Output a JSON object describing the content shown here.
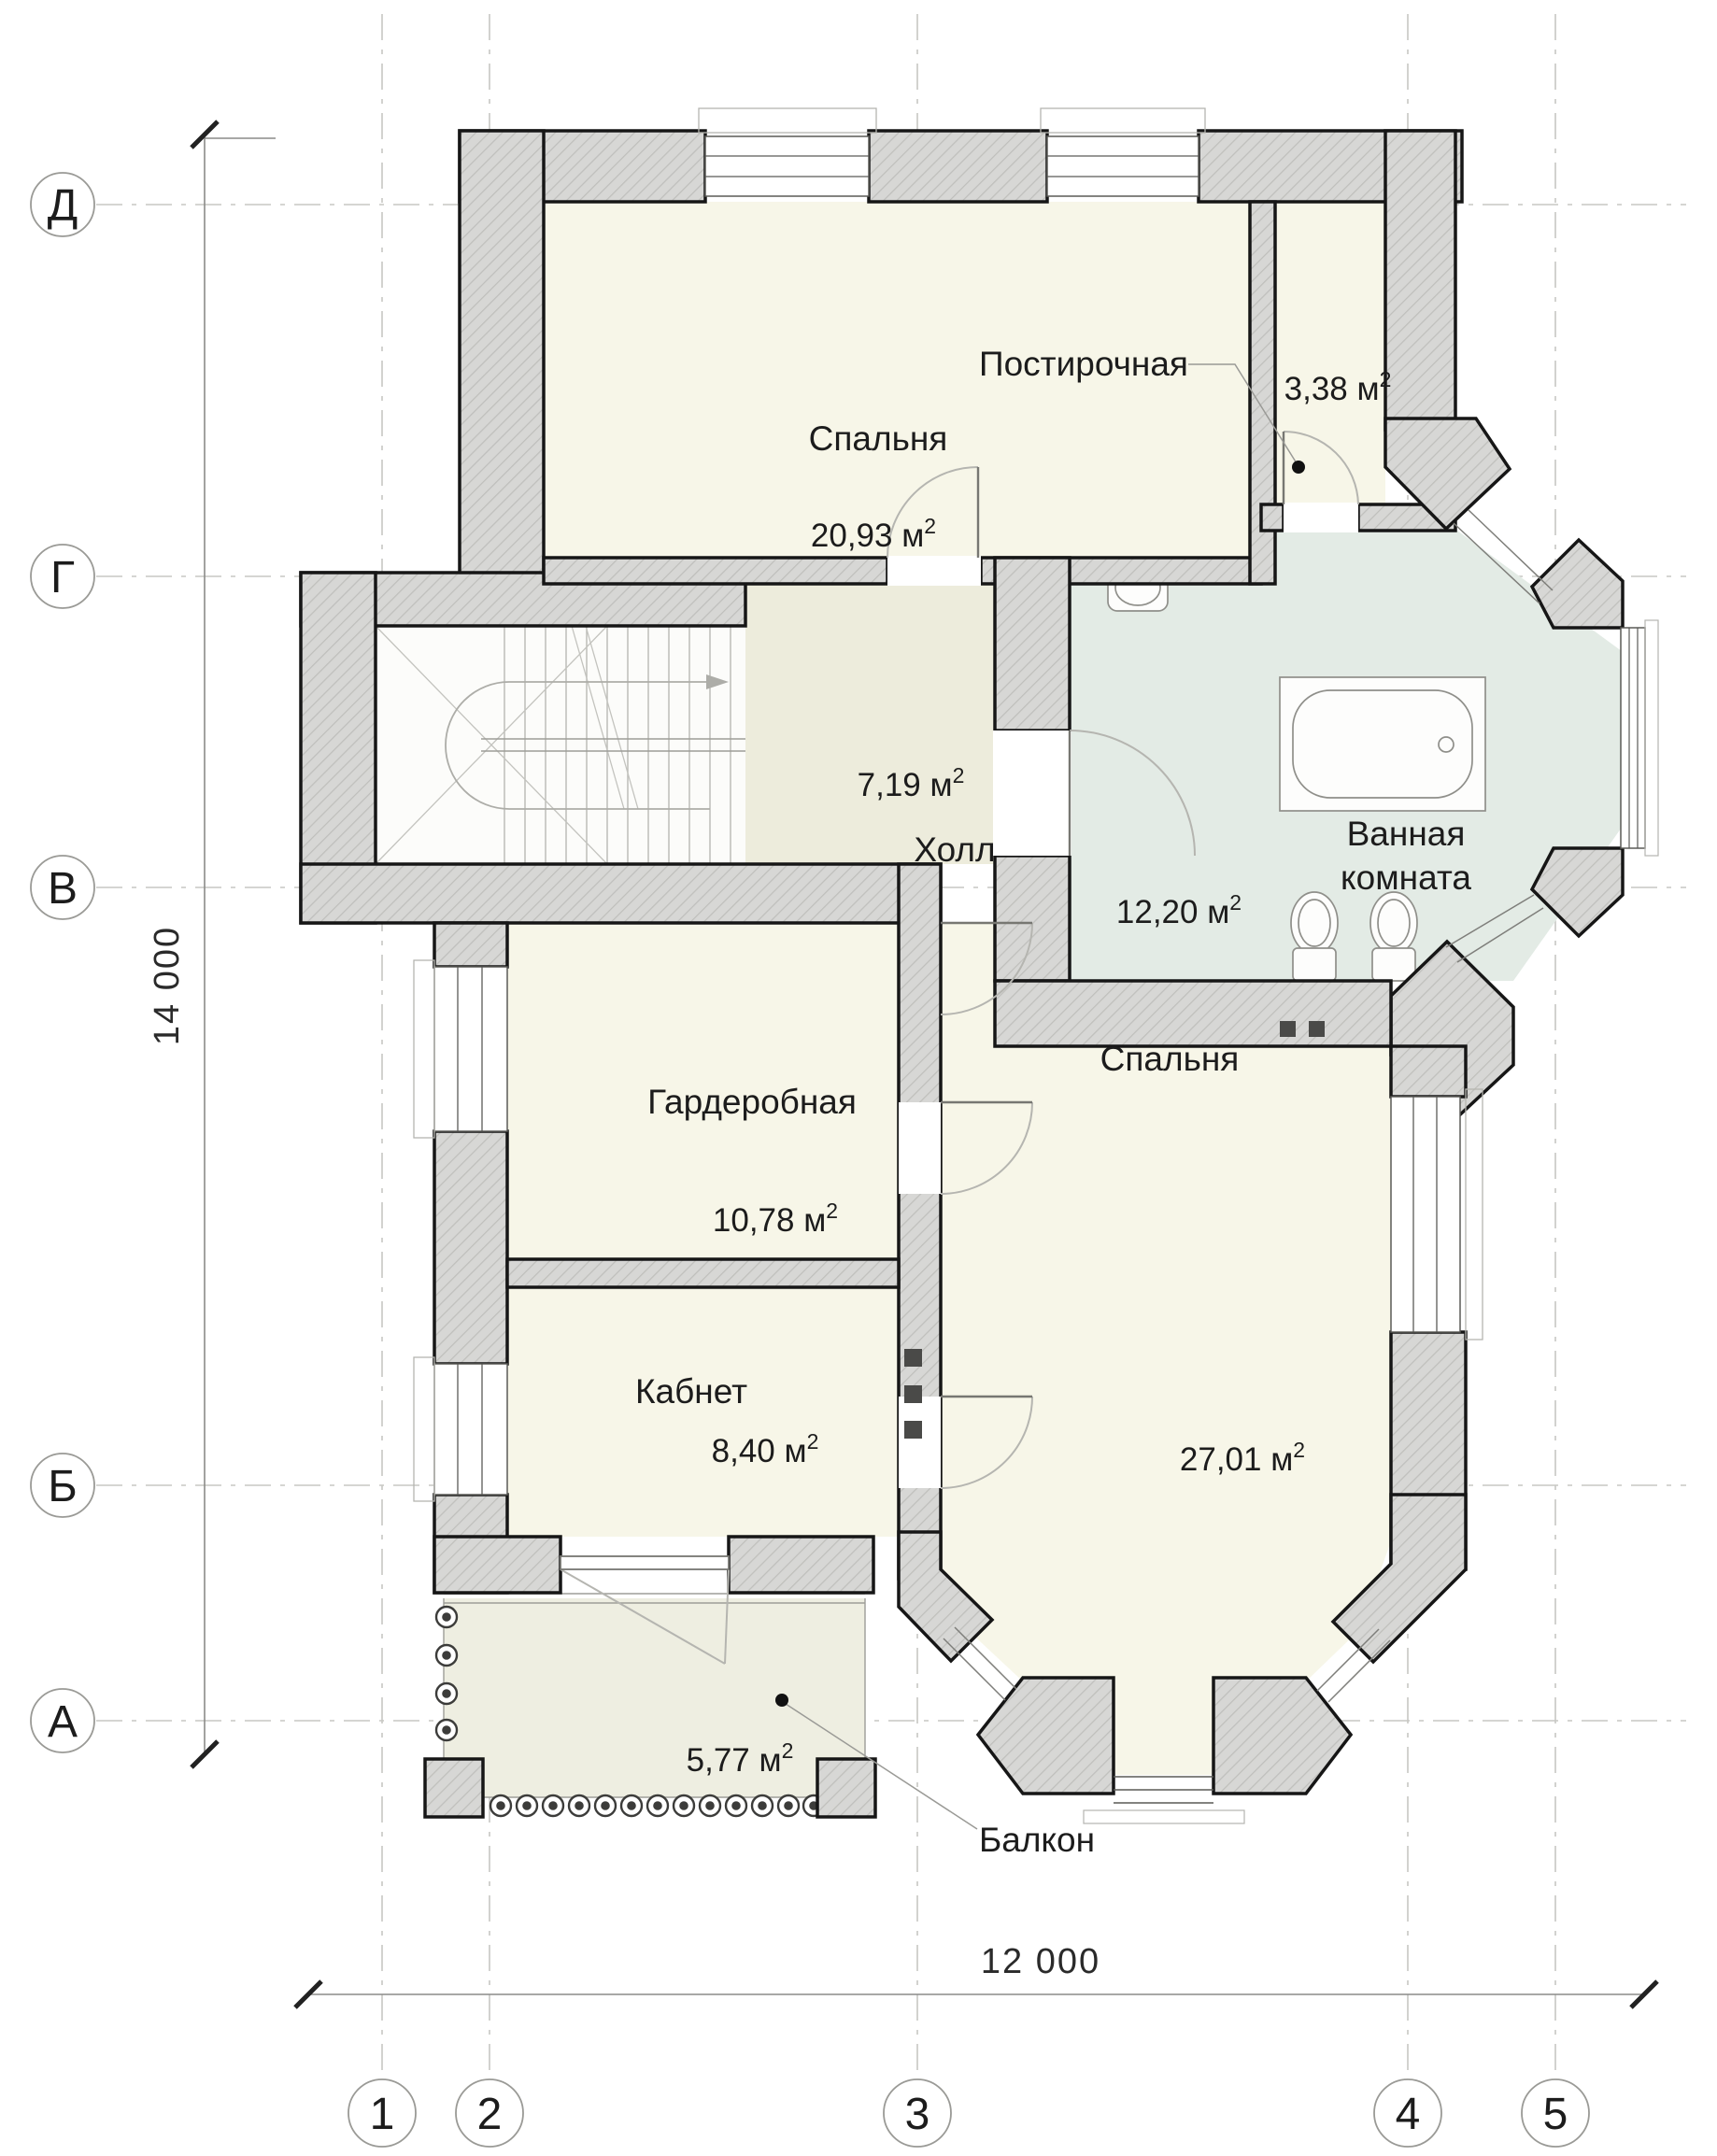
{
  "plan": {
    "type": "floor-plan",
    "rooms": [
      {
        "id": "bedroom-1",
        "name": "Спальня",
        "area": "20,93 м",
        "area_sup": "2"
      },
      {
        "id": "laundry",
        "name": "Постирочная",
        "area": "3,38 м",
        "area_sup": "2"
      },
      {
        "id": "hall",
        "name": "Холл",
        "area": "7,19 м",
        "area_sup": "2"
      },
      {
        "id": "bathroom",
        "name": "Ванная комната",
        "name_line1": "Ванная",
        "name_line2": "комната",
        "area": "12,20 м",
        "area_sup": "2"
      },
      {
        "id": "wardrobe",
        "name": "Гардеробная",
        "area": "10,78 м",
        "area_sup": "2"
      },
      {
        "id": "office",
        "name": "Кабнет",
        "area": "8,40 м",
        "area_sup": "2"
      },
      {
        "id": "bedroom-2",
        "name": "Спальня",
        "area": "27,01 м",
        "area_sup": "2"
      },
      {
        "id": "balcony",
        "name": "Балкон",
        "area": "5,77 м",
        "area_sup": "2"
      }
    ],
    "axes": {
      "row_labels": [
        "Д",
        "Г",
        "В",
        "Б",
        "А"
      ],
      "col_labels": [
        "1",
        "2",
        "3",
        "4",
        "5"
      ]
    },
    "dimensions": {
      "vertical_total": "14 000",
      "horizontal_total": "12 000"
    },
    "colors": {
      "wall_fill": "#d7d7d5",
      "wall_hatch": "#bfbfbc",
      "wall_stroke": "#161616",
      "room_ivory": "#f7f6e8",
      "hall_beige": "#edecdc",
      "bath_green": "#e3ebe5",
      "balcony_beige": "#eeeee1",
      "grid_gray": "#c7c7c3"
    }
  }
}
